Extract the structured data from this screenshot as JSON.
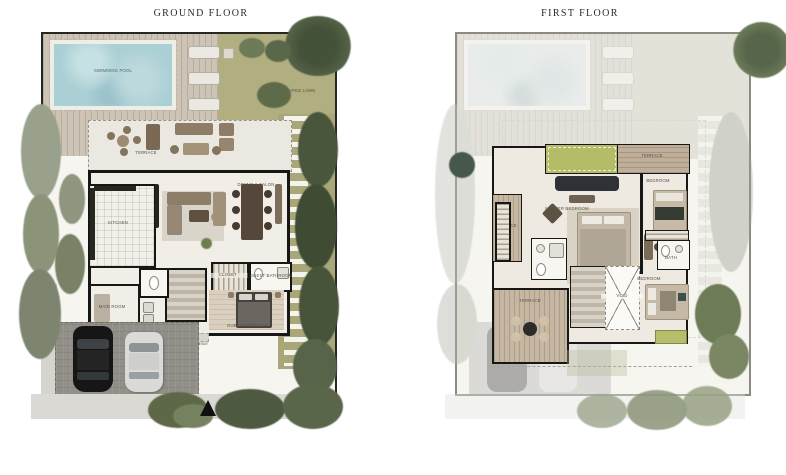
{
  "ground": {
    "title": "GROUND FLOOR",
    "rooms": {
      "pool": "SWIMMING POOL",
      "lawn": "LANDSCAPED LAWN",
      "terrace": "TERRACE",
      "dining": "DINING & SALON",
      "kitchen": "KITCHEN",
      "maid": "MAID ROOM",
      "closet": "CLOSET",
      "guest_bath": "GUEST BATHROOM",
      "guest_bed": "GUEST BEDROOM",
      "entrance": "Main Entrance"
    }
  },
  "first": {
    "title": "FIRST FLOOR",
    "rooms": {
      "terrace_left": "TERRACE",
      "terrace_top": "TERRACE",
      "terrace_bottom": "TERRACE",
      "master": "MASTER BEDROOM",
      "bedroom_right": "BEDROOM",
      "bedroom_bottom": "BEDROOM",
      "bath": "BATH",
      "void": "VOID"
    }
  },
  "colors": {
    "pool_water": "#aacfd5",
    "deck_wood": "#cdc4b6",
    "lawn_green": "#b1ae80",
    "tree_dark": "#43503a",
    "wall_black": "#171715",
    "floor_cream": "#f0eee6",
    "pavement_gray": "#928f88",
    "roof_garden_green": "#b5bc67"
  }
}
